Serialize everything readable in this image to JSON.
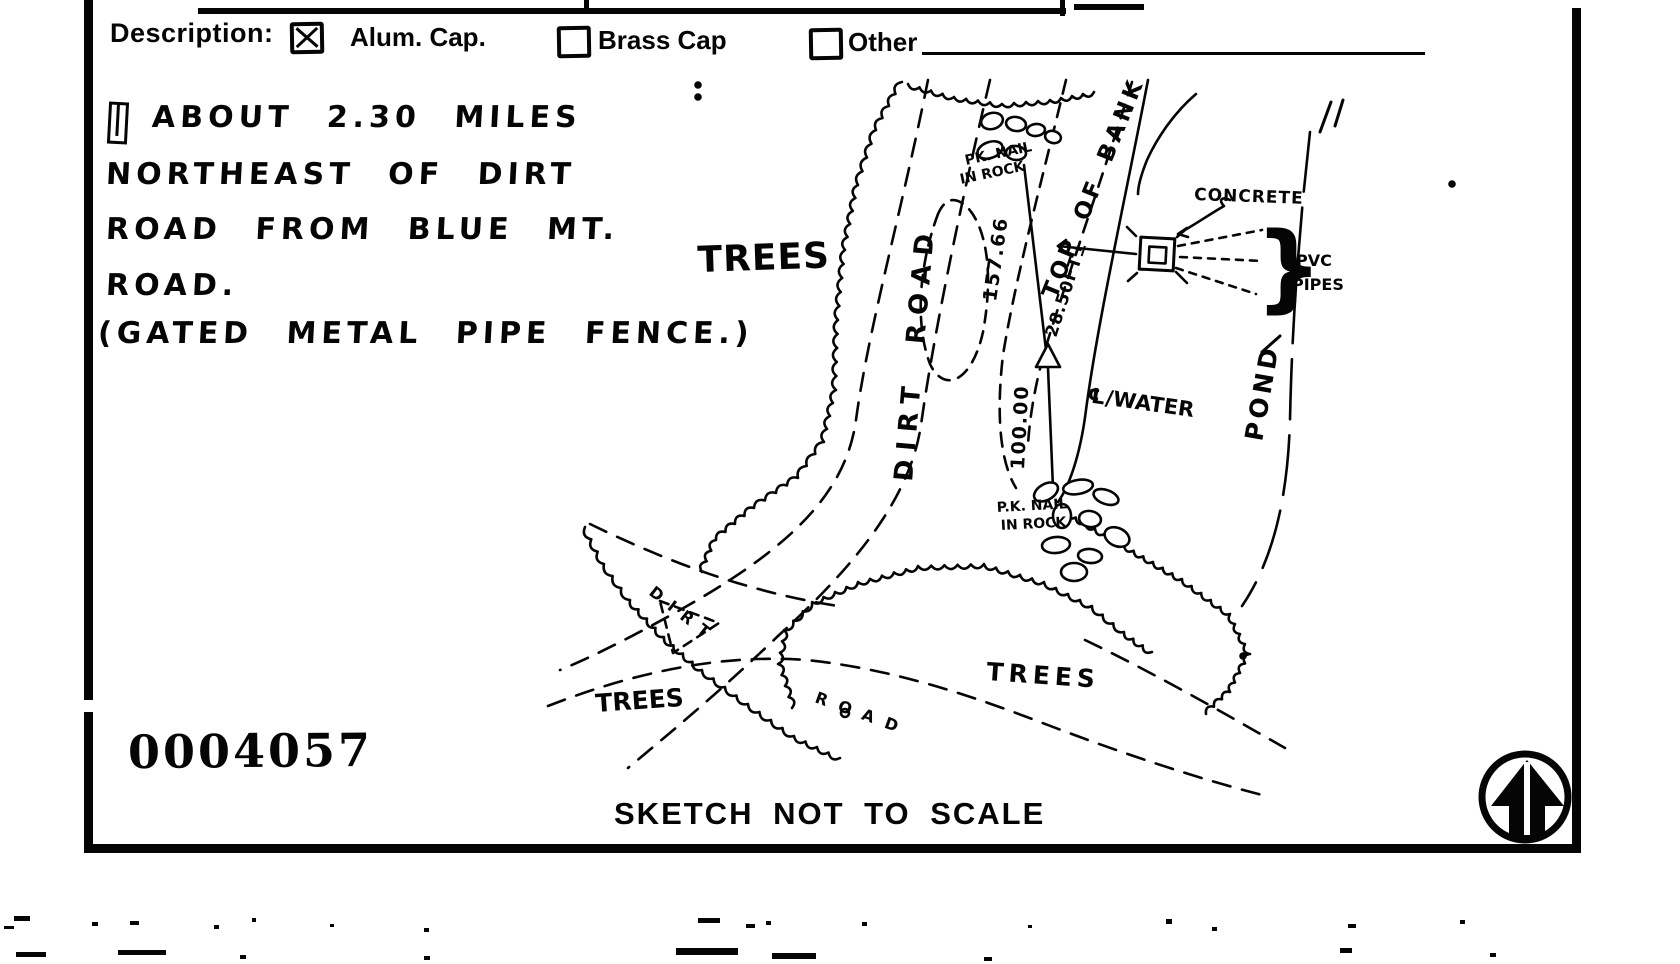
{
  "form_header": {
    "description_label": "Description:",
    "options": [
      {
        "label": "Alum. Cap.",
        "checked": true
      },
      {
        "label": "Brass Cap",
        "checked": false
      },
      {
        "label": "Other",
        "checked": false
      }
    ]
  },
  "location_note": {
    "lines": [
      "ABOUT 2.30 MILES",
      "NORTHEAST OF DIRT",
      "ROAD FROM BLUE MT.",
      "ROAD.",
      "(GATED METAL PIPE FENCE.)"
    ]
  },
  "sketch": {
    "labels": {
      "trees_upper_left": "TREES",
      "trees_lower_left": "TREES",
      "trees_lower_middle": "TREES",
      "dirt_road_vertical": "DIRT ROAD",
      "dirt_lower_road": "DIRT",
      "road_lower_road": "ROAD",
      "top_of_bank": "TOP OF BANK",
      "pond": "POND",
      "centerline_water": "℄/WATER",
      "concrete": "CONCRETE",
      "pvc": "PVC",
      "pipes": "PIPES",
      "pk_nail_upper_line1": "PK. NAIL",
      "pk_nail_upper_line2": "IN ROCK",
      "pk_nail_lower_line1": "P.K. NAIL",
      "pk_nail_lower_line2": "IN ROCK",
      "distance_to_upper_nail": "157.66",
      "distance_to_lower_nail": "100.00",
      "distance_to_concrete": "28.50FT±"
    }
  },
  "footer": {
    "document_number": "0004057",
    "scale_note": "SKETCH NOT TO SCALE"
  }
}
